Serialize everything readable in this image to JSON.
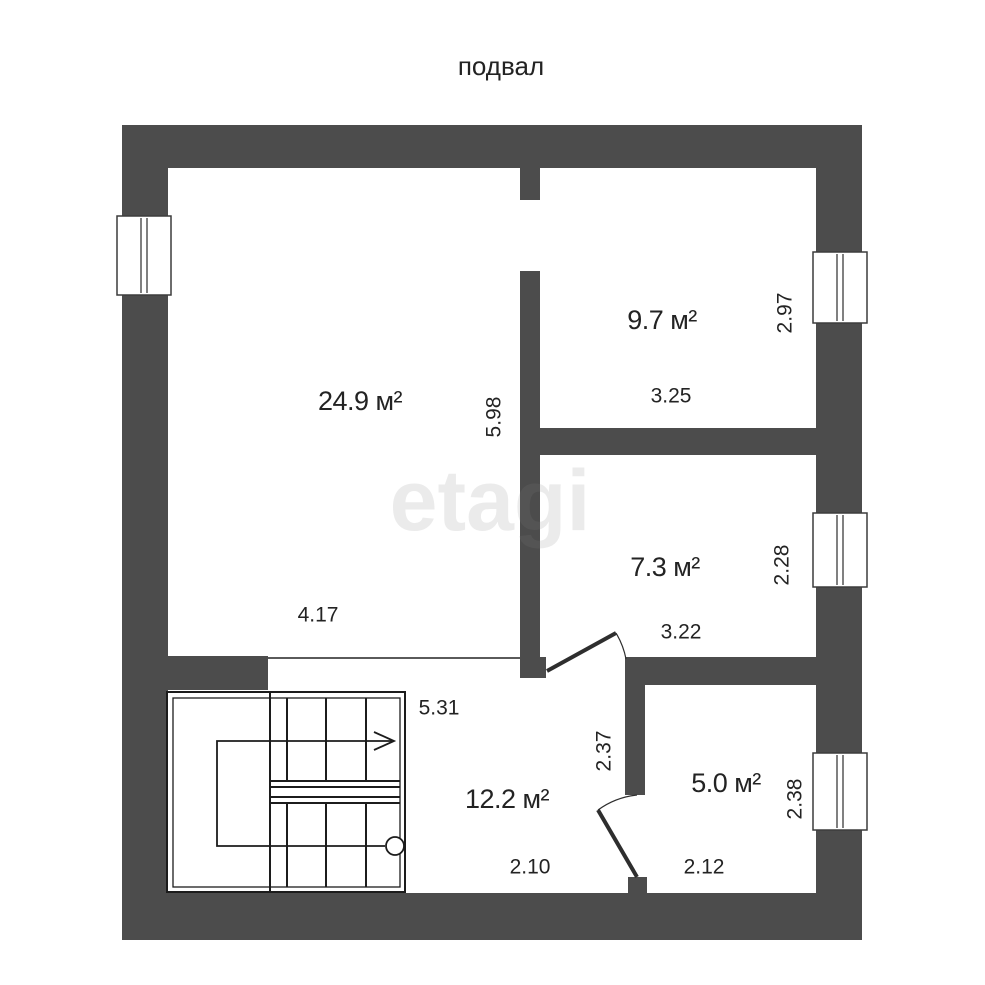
{
  "title": "подвал",
  "watermark": "etagi",
  "colors": {
    "wall": "#4c4c4c",
    "text": "#232323",
    "line": "#1c1c1c",
    "watermark": "rgba(128,128,128,0.16)"
  },
  "rooms": {
    "main": {
      "area": "24.9 м²",
      "width": "4.17",
      "height": "5.98"
    },
    "top_right": {
      "area": "9.7 м²",
      "width": "3.25",
      "height": "2.97"
    },
    "mid_right": {
      "area": "7.3 м²",
      "width": "3.22",
      "height": "2.28"
    },
    "hall": {
      "area": "12.2 м²",
      "width": "5.31",
      "height": "2.37",
      "bottom_width": "2.10"
    },
    "bottom_right": {
      "area": "5.0 м²",
      "width": "2.12",
      "height": "2.38"
    }
  }
}
